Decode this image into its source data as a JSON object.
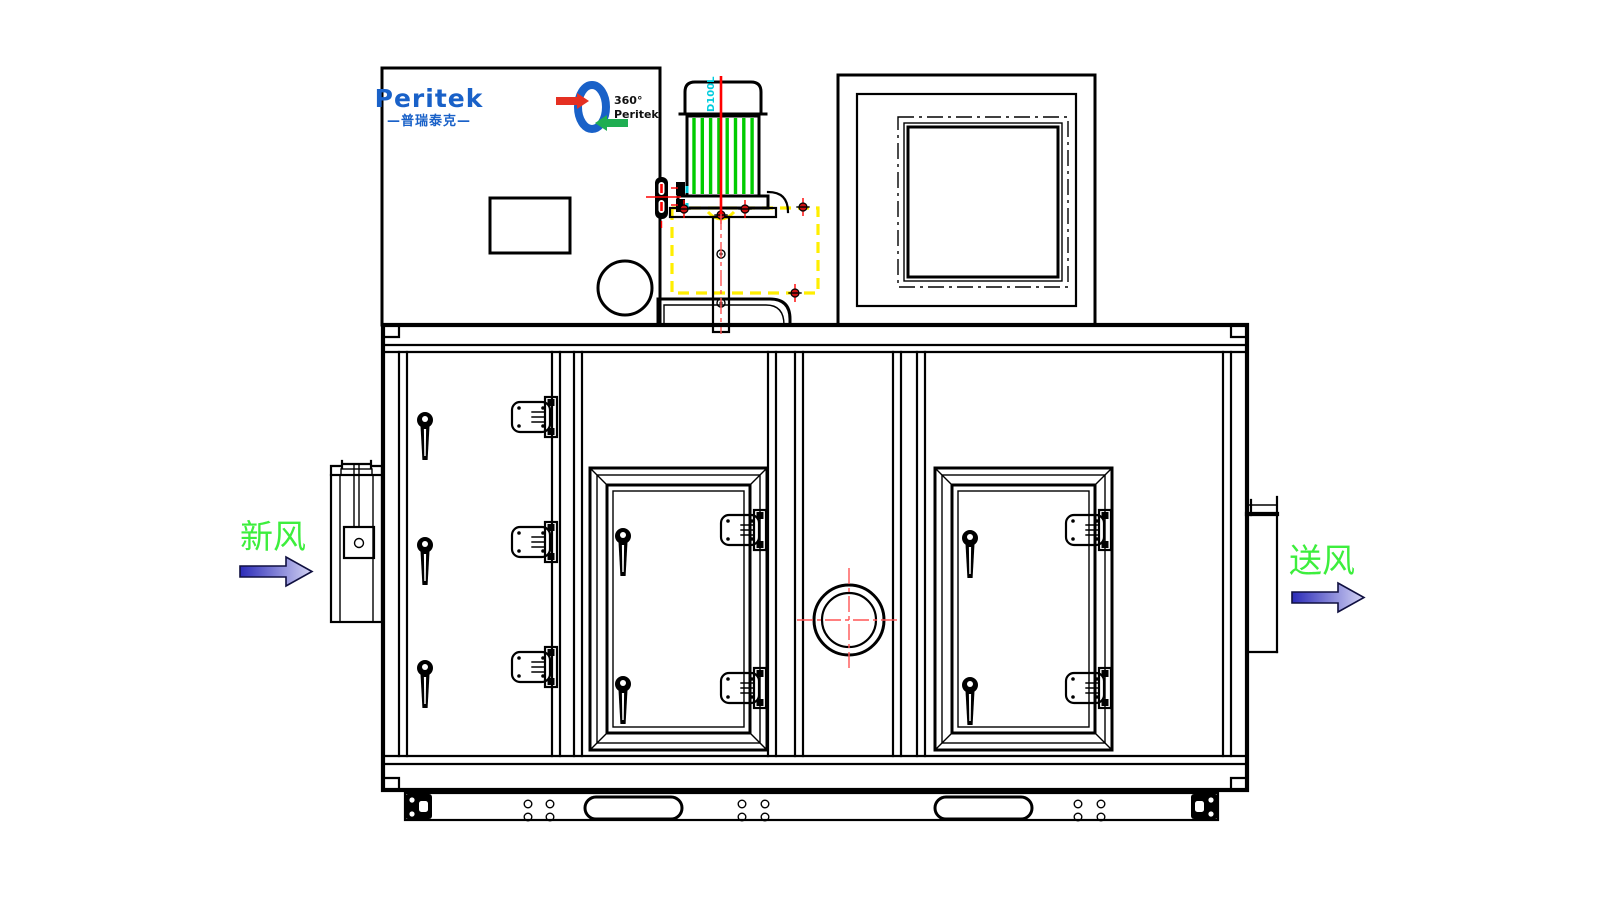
{
  "drawing_title": "Peritek dehumidifier unit front elevation",
  "brand": {
    "logo_text": "Peritek",
    "logo_subtext": "—普瑞泰克—",
    "rotor_degrees": "360°",
    "rotor_brand": "Peritek"
  },
  "labels": {
    "motor_model": "D100L",
    "inlet": "新风",
    "outlet": "送风"
  },
  "icons": {
    "inlet_arrow": "right-arrow",
    "outlet_arrow": "right-arrow",
    "rotor_logo": "rotor-wheel-with-arrows"
  },
  "colors": {
    "brand_blue": "#1961c8",
    "stripe_green": "#00cc00",
    "label_green": "#3dee3d",
    "centerline_red": "#ff0000",
    "hidden_yellow": "#ffee00",
    "cyan_label": "#00ccdd",
    "logo_red": "#e53022",
    "logo_green": "#1fae52",
    "arrow_dark": "#2b2bb8",
    "arrow_light": "#d4d4f4"
  }
}
